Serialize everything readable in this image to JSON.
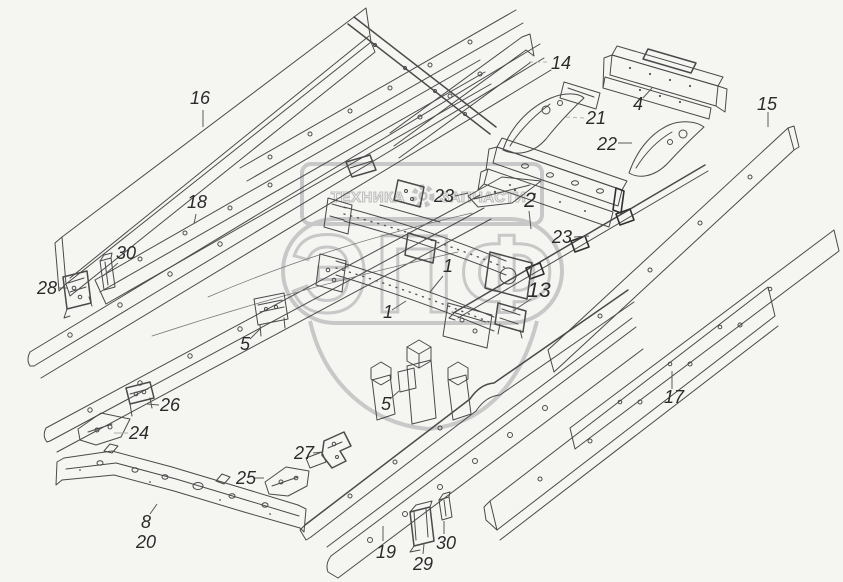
{
  "page": {
    "background_color": "#f5f5f2",
    "line_color": "#4a4a4a",
    "label_color": "#2b2b2b",
    "watermark_color": "#c6c6c6"
  },
  "watermark": {
    "header_left": "ТЕХНИКА",
    "header_right": "ЗАПЧАСТИ",
    "gear_icon": "gear",
    "logo_text": "ЭПФ"
  },
  "callouts": [
    {
      "label": "16"
    },
    {
      "label": "18"
    },
    {
      "label": "30"
    },
    {
      "label": "28"
    },
    {
      "label": "14"
    },
    {
      "label": "4"
    },
    {
      "label": "15"
    },
    {
      "label": "21"
    },
    {
      "label": "22"
    },
    {
      "label": "2"
    },
    {
      "label": "23"
    },
    {
      "label": "23"
    },
    {
      "label": "13"
    },
    {
      "label": "1"
    },
    {
      "label": "1"
    },
    {
      "label": "5"
    },
    {
      "label": "5"
    },
    {
      "label": "26"
    },
    {
      "label": "24"
    },
    {
      "label": "17"
    },
    {
      "label": "27"
    },
    {
      "label": "25"
    },
    {
      "label": "8"
    },
    {
      "label": "20"
    },
    {
      "label": "19"
    },
    {
      "label": "29"
    },
    {
      "label": "30"
    }
  ]
}
